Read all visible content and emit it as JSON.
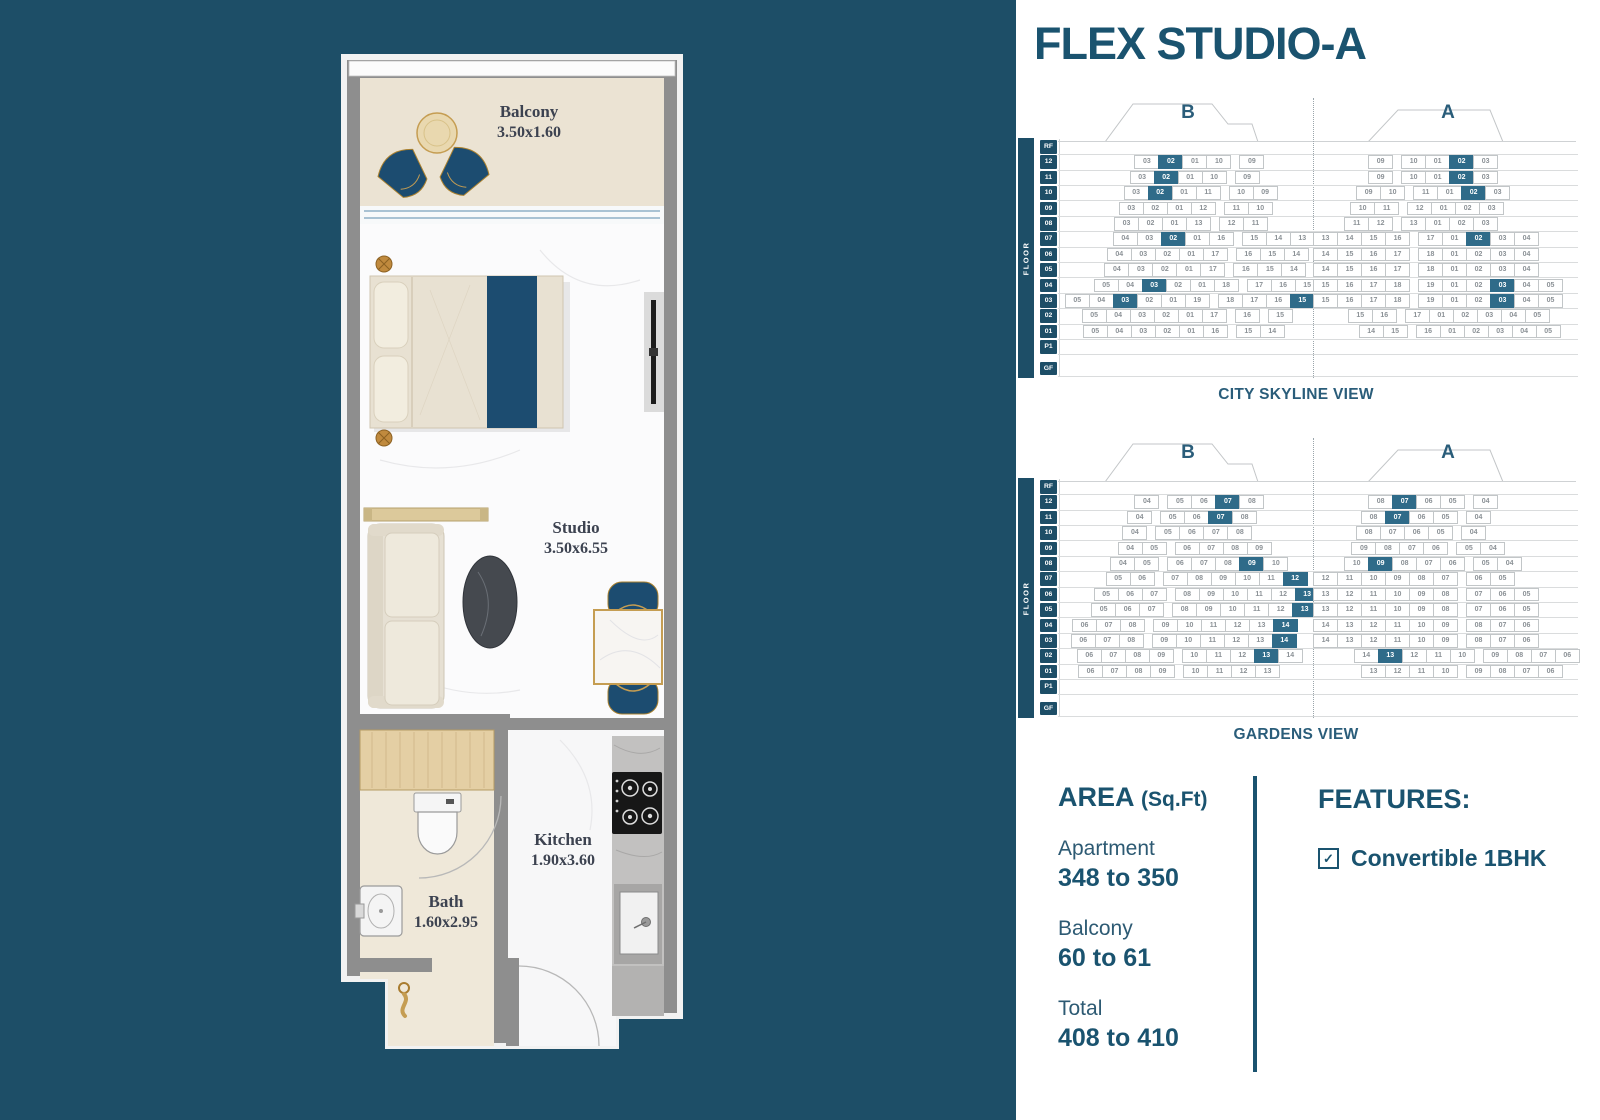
{
  "title": "FLEX STUDIO-A",
  "colors": {
    "background_teal": "#1d4e67",
    "accent_text": "#1a536f",
    "highlight_cell": "#2f6b89",
    "furniture_blue": "#1c4c70",
    "gold": "#c59d52"
  },
  "floorplan": {
    "balcony": {
      "name": "Balcony",
      "dims": "3.50x1.60"
    },
    "studio": {
      "name": "Studio",
      "dims": "3.50x6.55"
    },
    "kitchen": {
      "name": "Kitchen",
      "dims": "1.90x3.60"
    },
    "bath": {
      "name": "Bath",
      "dims": "1.60x2.95"
    }
  },
  "diagrams": [
    {
      "caption": "CITY SKYLINE VIEW",
      "floor_axis_label": "FLOOR",
      "towers": [
        "B",
        "A"
      ],
      "rows": [
        {
          "f": "RF"
        },
        {
          "f": "12",
          "b": {
            "pad": 3.1,
            "cells": [
              "03",
              "02*",
              "01",
              "10",
              "|",
              "09"
            ]
          },
          "a": {
            "pad": 2.3,
            "cells": [
              "09",
              "|",
              "10",
              "01",
              "02*",
              "03"
            ]
          }
        },
        {
          "f": "11",
          "b": {
            "pad": 2.9,
            "cells": [
              "03",
              "02*",
              "01",
              "10",
              "|",
              "09"
            ]
          },
          "a": {
            "pad": 2.3,
            "cells": [
              "09",
              "|",
              "10",
              "01",
              "02*",
              "03"
            ]
          }
        },
        {
          "f": "10",
          "b": {
            "pad": 2.65,
            "cells": [
              "03",
              "02*",
              "01",
              "11",
              "|",
              "10",
              "09"
            ]
          },
          "a": {
            "pad": 1.8,
            "cells": [
              "09",
              "10",
              "|",
              "11",
              "01",
              "02*",
              "03"
            ]
          }
        },
        {
          "f": "09",
          "b": {
            "pad": 2.45,
            "cells": [
              "03",
              "02",
              "01",
              "12",
              "|",
              "11",
              "10"
            ]
          },
          "a": {
            "pad": 1.55,
            "cells": [
              "10",
              "11",
              "|",
              "12",
              "01",
              "02",
              "03"
            ]
          }
        },
        {
          "f": "08",
          "b": {
            "pad": 2.25,
            "cells": [
              "03",
              "02",
              "01",
              "13",
              "|",
              "12",
              "11"
            ]
          },
          "a": {
            "pad": 1.3,
            "cells": [
              "11",
              "12",
              "|",
              "13",
              "01",
              "02",
              "03"
            ]
          }
        },
        {
          "f": "07",
          "b": {
            "pad": 2.2,
            "cells": [
              "04",
              "03",
              "02*",
              "01",
              "16",
              "|",
              "15",
              "14",
              "13"
            ]
          },
          "a": {
            "pad": 0,
            "cells": [
              "13",
              "14",
              "15",
              "16",
              "|",
              "17",
              "01",
              "02*",
              "03",
              "04"
            ]
          }
        },
        {
          "f": "06",
          "b": {
            "pad": 1.95,
            "cells": [
              "04",
              "03",
              "02",
              "01",
              "17",
              "|",
              "16",
              "15",
              "14"
            ]
          },
          "a": {
            "pad": 0,
            "cells": [
              "14",
              "15",
              "16",
              "17",
              "|",
              "18",
              "01",
              "02",
              "03",
              "04"
            ]
          }
        },
        {
          "f": "05",
          "b": {
            "pad": 1.85,
            "cells": [
              "04",
              "03",
              "02",
              "01",
              "17",
              "|",
              "16",
              "15",
              "14"
            ]
          },
          "a": {
            "pad": 0,
            "cells": [
              "14",
              "15",
              "16",
              "17",
              "|",
              "18",
              "01",
              "02",
              "03",
              "04"
            ]
          }
        },
        {
          "f": "04",
          "b": {
            "pad": 1.4,
            "cells": [
              "05",
              "04",
              "03*",
              "02",
              "01",
              "18",
              "|",
              "17",
              "16",
              "15"
            ]
          },
          "a": {
            "pad": 0,
            "cells": [
              "15",
              "16",
              "17",
              "18",
              "|",
              "19",
              "01",
              "02",
              "03*",
              "04",
              "05"
            ]
          }
        },
        {
          "f": "03",
          "b": {
            "pad": 0.2,
            "cells": [
              "05",
              "04",
              "03*",
              "02",
              "01",
              "19",
              "|",
              "18",
              "17",
              "16",
              "15*"
            ]
          },
          "a": {
            "pad": 0,
            "cells": [
              "15",
              "16",
              "17",
              "18",
              "|",
              "19",
              "01",
              "02",
              "03*",
              "04",
              "05"
            ]
          }
        },
        {
          "f": "02",
          "b": {
            "pad": 0.9,
            "cells": [
              "05",
              "04",
              "03",
              "02",
              "01",
              "17",
              "|",
              "16",
              "|",
              "15"
            ]
          },
          "a": {
            "pad": 1.45,
            "cells": [
              "15",
              "16",
              "|",
              "17",
              "01",
              "02",
              "03",
              "04",
              "05"
            ]
          }
        },
        {
          "f": "01",
          "b": {
            "pad": 0.95,
            "cells": [
              "05",
              "04",
              "03",
              "02",
              "01",
              "16",
              "|",
              "15",
              "14"
            ]
          },
          "a": {
            "pad": 1.9,
            "cells": [
              "14",
              "15",
              "|",
              "16",
              "01",
              "02",
              "03",
              "04",
              "05"
            ]
          }
        },
        {
          "f": "P1"
        },
        {
          "f": "GF"
        }
      ]
    },
    {
      "caption": "GARDENS VIEW",
      "floor_axis_label": "FLOOR",
      "towers": [
        "B",
        "A"
      ],
      "rows": [
        {
          "f": "RF"
        },
        {
          "f": "12",
          "b": {
            "pad": 3.1,
            "cells": [
              "04",
              "|",
              "05",
              "06",
              "07*",
              "08"
            ]
          },
          "a": {
            "pad": 2.3,
            "cells": [
              "08",
              "07*",
              "06",
              "05",
              "|",
              "04"
            ]
          }
        },
        {
          "f": "11",
          "b": {
            "pad": 2.8,
            "cells": [
              "04",
              "|",
              "05",
              "06",
              "07*",
              "08"
            ]
          },
          "a": {
            "pad": 2.0,
            "cells": [
              "08",
              "07*",
              "06",
              "05",
              "|",
              "04"
            ]
          }
        },
        {
          "f": "10",
          "b": {
            "pad": 2.6,
            "cells": [
              "04",
              "|",
              "05",
              "06",
              "07",
              "08"
            ]
          },
          "a": {
            "pad": 1.8,
            "cells": [
              "08",
              "07",
              "06",
              "05",
              "|",
              "04"
            ]
          }
        },
        {
          "f": "09",
          "b": {
            "pad": 2.4,
            "cells": [
              "04",
              "05",
              "|",
              "06",
              "07",
              "08",
              "09"
            ]
          },
          "a": {
            "pad": 1.6,
            "cells": [
              "09",
              "08",
              "07",
              "06",
              "|",
              "05",
              "04"
            ]
          }
        },
        {
          "f": "08",
          "b": {
            "pad": 2.1,
            "cells": [
              "04",
              "05",
              "|",
              "06",
              "07",
              "08",
              "09*",
              "10"
            ]
          },
          "a": {
            "pad": 1.3,
            "cells": [
              "10",
              "09*",
              "08",
              "07",
              "06",
              "|",
              "05",
              "04"
            ]
          }
        },
        {
          "f": "07",
          "b": {
            "pad": 1.9,
            "cells": [
              "05",
              "06",
              "|",
              "07",
              "08",
              "09",
              "10",
              "11",
              "12*"
            ]
          },
          "a": {
            "pad": 0,
            "cells": [
              "12",
              "11",
              "10",
              "09",
              "08",
              "07",
              "|",
              "06",
              "05"
            ]
          }
        },
        {
          "f": "06",
          "b": {
            "pad": 1.4,
            "cells": [
              "05",
              "06",
              "07",
              "|",
              "08",
              "09",
              "10",
              "11",
              "12",
              "13*"
            ]
          },
          "a": {
            "pad": 0,
            "cells": [
              "13",
              "12",
              "11",
              "10",
              "09",
              "08",
              "|",
              "07",
              "06",
              "05"
            ]
          }
        },
        {
          "f": "05",
          "b": {
            "pad": 1.3,
            "cells": [
              "05",
              "06",
              "07",
              "|",
              "08",
              "09",
              "10",
              "11",
              "12",
              "13*"
            ]
          },
          "a": {
            "pad": 0,
            "cells": [
              "13",
              "12",
              "11",
              "10",
              "09",
              "08",
              "|",
              "07",
              "06",
              "05"
            ]
          }
        },
        {
          "f": "04",
          "b": {
            "pad": 0.5,
            "cells": [
              "06",
              "07",
              "08",
              "|",
              "09",
              "10",
              "11",
              "12",
              "13",
              "14*"
            ]
          },
          "a": {
            "pad": 0,
            "cells": [
              "14",
              "13",
              "12",
              "11",
              "10",
              "09",
              "|",
              "08",
              "07",
              "06"
            ]
          }
        },
        {
          "f": "03",
          "b": {
            "pad": 0.45,
            "cells": [
              "06",
              "07",
              "08",
              "|",
              "09",
              "10",
              "11",
              "12",
              "13",
              "14*"
            ]
          },
          "a": {
            "pad": 0,
            "cells": [
              "14",
              "13",
              "12",
              "11",
              "10",
              "09",
              "|",
              "08",
              "07",
              "06"
            ]
          }
        },
        {
          "f": "02",
          "b": {
            "pad": 0.7,
            "cells": [
              "06",
              "07",
              "08",
              "09",
              "|",
              "10",
              "11",
              "12",
              "13*",
              "14"
            ]
          },
          "a": {
            "pad": 1.7,
            "cells": [
              "14",
              "13*",
              "12",
              "11",
              "10",
              "|",
              "09",
              "08",
              "07",
              "06"
            ]
          }
        },
        {
          "f": "01",
          "b": {
            "pad": 0.75,
            "cells": [
              "06",
              "07",
              "08",
              "09",
              "|",
              "10",
              "11",
              "12",
              "13"
            ]
          },
          "a": {
            "pad": 2.0,
            "cells": [
              "13",
              "12",
              "11",
              "10",
              "|",
              "09",
              "08",
              "07",
              "06"
            ]
          }
        },
        {
          "f": "P1"
        },
        {
          "f": "GF"
        }
      ]
    }
  ],
  "area": {
    "heading": "AREA",
    "heading_unit": "(Sq.Ft)",
    "items": [
      {
        "label": "Apartment",
        "value": "348 to 350"
      },
      {
        "label": "Balcony",
        "value": "60 to 61"
      },
      {
        "label": "Total",
        "value": "408 to 410"
      }
    ]
  },
  "features": {
    "heading": "FEATURES:",
    "items": [
      {
        "label": "Convertible 1BHK",
        "checked": true,
        "check_glyph": "✓"
      }
    ]
  }
}
